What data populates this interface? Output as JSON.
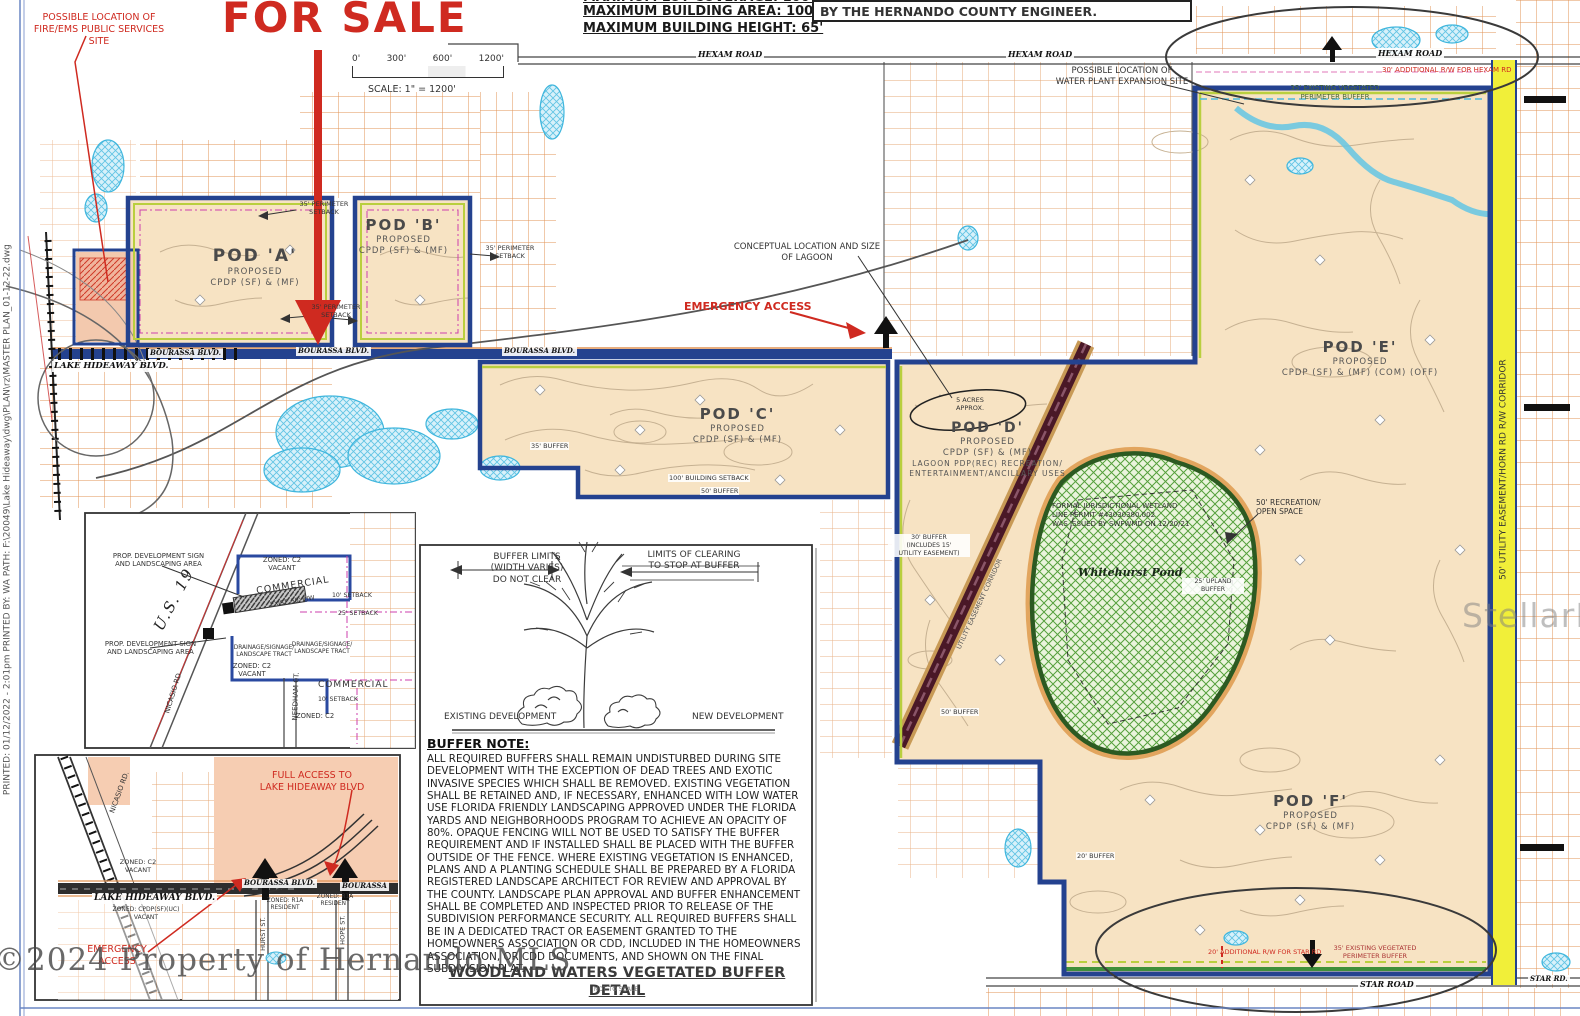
{
  "header": {
    "clipped_line": "MAXIMUM LOT COVERAGE: 100%",
    "building_area": "MAXIMUM BUILDING AREA: 100%",
    "building_height": "MAXIMUM BUILDING HEIGHT: 65'",
    "engineer_box": "BY THE HERNANDO COUNTY ENGINEER."
  },
  "scalebar": {
    "t0": "0'",
    "t1": "300'",
    "t2": "600'",
    "t3": "1200'",
    "label": "SCALE: 1\" = 1200'"
  },
  "annotations": {
    "for_sale": "FOR SALE",
    "fire_ems": "POSSIBLE LOCATION OF\nFIRE/EMS PUBLIC SERVICES\nSITE",
    "water_plant": "POSSIBLE LOCATION OF\nWATER PLANT EXPANSION SITE",
    "conceptual_lagoon": "CONCEPTUAL LOCATION AND SIZE\nOF LAGOON",
    "emergency_access": "EMERGENCY ACCESS",
    "lagoon_acres": "5 ACRES\nAPPROX.",
    "hexam_rw": "30' ADDITIONAL R/W FOR HEXAM RD",
    "hexam_buffer": "35' EXISTING VEGETATED\nPERIMETER BUFFER",
    "star_rw": "20' ADDITIONAL R/W FOR STAR RD",
    "star_buffer": "35' EXISTING VEGETATED\nPERIMETER BUFFER",
    "recreation": "50' RECREATION/\nOPEN SPACE",
    "wetland_note": "FORMAL JURISDICTIONAL WETLAND\nLINE PERMIT #43030380.002\nWAS ISSUED BY SWFWMD ON 12/20/21",
    "upland_buffer": "25' UPLAND\nBUFFER",
    "buffer_35": "35' BUFFER",
    "building_setback_100": "100' BUILDING SETBACK",
    "buffer_50": "50' BUFFER",
    "buffer_30_utility": "30' BUFFER\n(INCLUDES 15'\nUTILITY EASEMENT)",
    "buffer_20": "20' BUFFER",
    "perimeter_setback": "35' PERIMETER\nSETBACK",
    "utility_corridor": "UTILITY EASEMENT CORRIDOR"
  },
  "pods": {
    "a": {
      "title": "POD 'A'",
      "l1": "PROPOSED",
      "l2": "CPDP (SF) & (MF)"
    },
    "b": {
      "title": "POD 'B'",
      "l1": "PROPOSED",
      "l2": "CPDP (SF) & (MF)"
    },
    "c": {
      "title": "POD 'C'",
      "l1": "PROPOSED",
      "l2": "CPDP (SF) & (MF)"
    },
    "d": {
      "title": "POD 'D'",
      "l1": "PROPOSED",
      "l2": "CPDP (SF) & (MF)",
      "l3": "LAGOON PDP(REC) RECREATION/",
      "l4": "ENTERTAINMENT/ANCILLARY USES"
    },
    "e": {
      "title": "POD 'E'",
      "l1": "PROPOSED",
      "l2": "CPDP (SF) & (MF) (COM) (OFF)"
    },
    "f": {
      "title": "POD 'F'",
      "l1": "PROPOSED",
      "l2": "CPDP (SF) & (MF)"
    }
  },
  "roads": {
    "hexam": "HEXAM ROAD",
    "bourassa": "BOURASSA BLVD.",
    "lake_hideaway": "LAKE HIDEAWAY BLVD.",
    "star_road": "STAR ROAD",
    "star_rd": "STAR RD.",
    "pond": "Whitehurst Pond",
    "yellow_band": "50' UTILITY EASEMENT/HORN RD R/W CORRIDOR"
  },
  "inset_us19": {
    "prop_sign": "PROP. DEVELOPMENT SIGN\nAND LANDSCAPING AREA",
    "us19": "U.S. 19",
    "zoned_c2_vacant": "ZONED: C2\nVACANT",
    "zoned_c2": "ZONED: C2",
    "commercial": "COMMERCIAL",
    "exist_rw": "EXIST. 50' R/W",
    "setback_10": "10' SETBACK",
    "setback_25": "25' SETBACK",
    "drainage": "DRAINAGE/SIGNAGE/\nLANDSCAPE TRACT",
    "nicasio": "NICASIO RD.",
    "needham": "NEEDHAM CT."
  },
  "inset_access": {
    "full_access": "FULL ACCESS TO\nLAKE HIDEAWAY BLVD",
    "lake_hideaway": "LAKE HIDEAWAY BLVD.",
    "zoned_cpdp": "ZONED: CPDP(SF)(UC)\nVACANT",
    "bourassa_blvd": "BOURASSA BLVD.",
    "bourassa": "BOURASSA",
    "emergency": "EMERGENCY\nACCESS",
    "nicasio": "NICASIO RD.",
    "zoned_c2_vacant": "ZONED: C2\nVACANT",
    "zoned_r1a": "ZONED: R1A\nRESIDENT",
    "hurst_st": "HURST ST.",
    "hope_st": "HOPE ST."
  },
  "buffer_detail": {
    "dim_left": "BUFFER LIMITS\n(WIDTH VARIES)\nDO NOT CLEAR",
    "dim_right": "LIMITS OF CLEARING\nTO STOP AT BUFFER",
    "existing": "EXISTING DEVELOPMENT",
    "new_dev": "NEW DEVELOPMENT",
    "note_title": "BUFFER NOTE:",
    "note_body": "ALL REQUIRED BUFFERS SHALL REMAIN UNDISTURBED DURING SITE DEVELOPMENT WITH THE EXCEPTION OF DEAD TREES AND EXOTIC INVASIVE SPECIES WHICH SHALL BE REMOVED.  EXISTING VEGETATION SHALL BE RETAINED AND, IF NECESSARY, ENHANCED WITH LOW WATER USE FLORIDA FRIENDLY LANDSCAPING APPROVED UNDER THE FLORIDA YARDS AND NEIGHBORHOODS PROGRAM TO ACHIEVE AN OPACITY OF 80%. OPAQUE FENCING WILL NOT BE USED TO SATISFY THE BUFFER REQUIREMENT AND IF INSTALLED SHALL BE PLACED WITH THE BUFFER OUTSIDE OF THE FENCE.  WHERE EXISTING VEGETATION IS ENHANCED, PLANS AND A PLANTING SCHEDULE SHALL BE PREPARED BY A FLORIDA REGISTERED LANDSCAPE ARCHITECT FOR REVIEW AND APPROVAL BY THE COUNTY.  LANDSCAPE PLAN APPROVAL AND BUFFER ENHANCEMENT SHALL BE COMPLETED AND INSPECTED  PRIOR TO RELEASE OF THE SUBDIVISION PERFORMANCE SECURITY.  ALL REQUIRED BUFFERS SHALL BE IN A DEDICATED TRACT OR EASEMENT GRANTED TO THE HOMEOWNERS ASSOCIATION OR CDD, INCLUDED IN THE HOMEOWNERS ASSOCIATION, OR CDD DOCUMENTS, AND SHOWN ON THE FINAL SUBDIVISION PLAT.",
    "title": "WOODLAND WATERS VEGETATED BUFFER DETAIL",
    "not_to_scale": "NOT TO SCALE"
  },
  "margins": {
    "plot_stamp": "PRINTED: 01/12/2022 - 2:01pm      PRINTED BY: WA      PATH: F:\\20049\\Lake Hideaway\\dwg\\PLAN\\rz\\MASTER PLAN_01-12-22.dwg"
  },
  "watermarks": {
    "hernando": "©2024 Property of Hernando MLS",
    "stellar": "StellarMLS"
  }
}
